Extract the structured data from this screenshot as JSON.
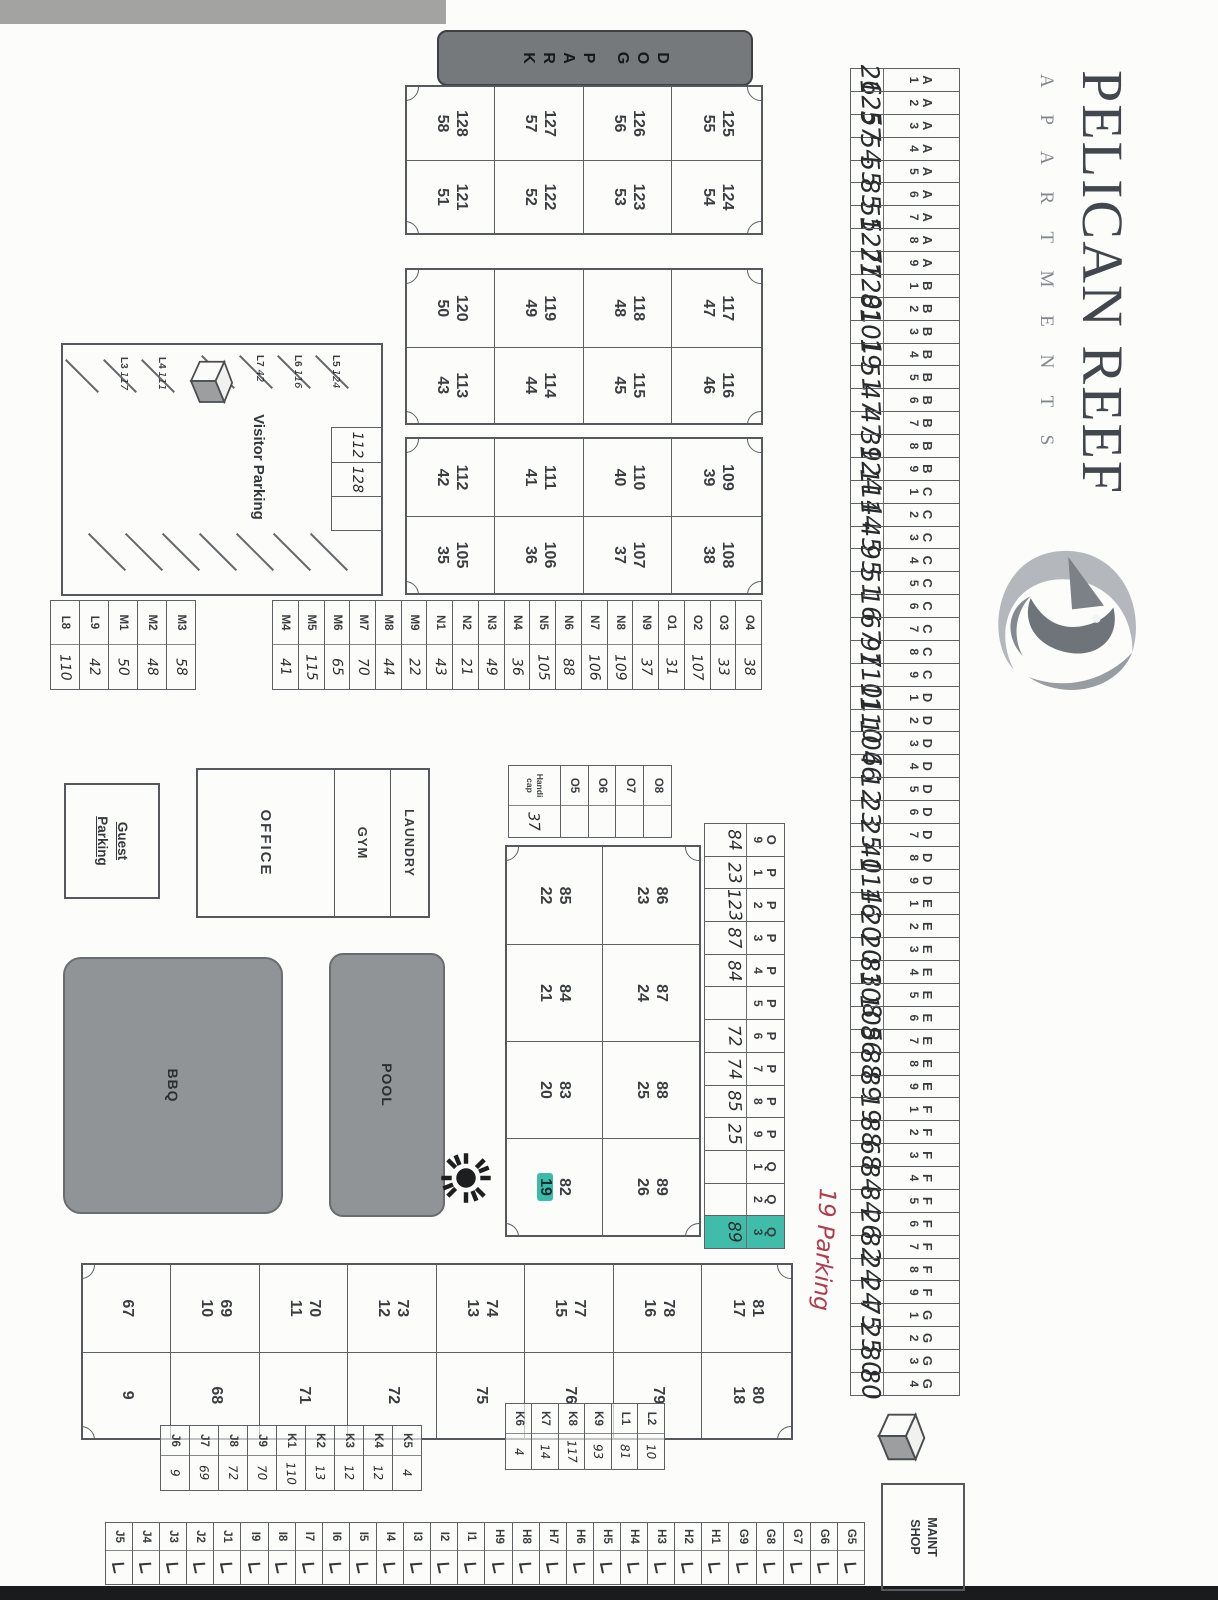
{
  "header": {
    "title": "PELICAN REEF",
    "subtitle": "A P A R T M E N T S"
  },
  "amenities": {
    "dog_park": "DOG PARK",
    "office": "OFFICE",
    "gym": "GYM",
    "laundry": "LAUNDRY",
    "pool": "POOL",
    "bbq": "BBQ",
    "guest_parking": "Guest Parking",
    "visitor_parking": "Visitor Parking",
    "maint_shop": "MAINT SHOP",
    "handicap_label": "Handi cap"
  },
  "annotations": {
    "red_note": "19 Parking",
    "red_color": "#b23b4b",
    "highlight_color": "#3bbcaa"
  },
  "parking": {
    "top_row": [
      {
        "s": "A1",
        "v": "26"
      },
      {
        "s": "A2",
        "v": "125"
      },
      {
        "s": "A3",
        "v": "57"
      },
      {
        "s": "A4",
        "v": "54"
      },
      {
        "s": "A5",
        "v": "55"
      },
      {
        "s": "A6",
        "v": "85"
      },
      {
        "s": "A7",
        "v": "55"
      },
      {
        "s": "A8",
        "v": "127"
      },
      {
        "s": "A9",
        "v": "27"
      },
      {
        "s": "B1",
        "v": "120"
      },
      {
        "s": "B2",
        "v": "81"
      },
      {
        "s": "B3",
        "v": "101"
      },
      {
        "s": "B4",
        "v": "19"
      },
      {
        "s": "B5",
        "v": "51"
      },
      {
        "s": "B6",
        "v": "47"
      },
      {
        "s": "B7",
        "v": "47"
      },
      {
        "s": "B8",
        "v": "39"
      },
      {
        "s": "B9",
        "v": "124"
      },
      {
        "s": "C1",
        "v": "114"
      },
      {
        "s": "C2",
        "v": "14"
      },
      {
        "s": "C3",
        "v": "45"
      },
      {
        "s": "C4",
        "v": "95"
      },
      {
        "s": "C5",
        "v": "51"
      },
      {
        "s": "C6",
        "v": "16"
      },
      {
        "s": "C7",
        "v": "67"
      },
      {
        "s": "C8",
        "v": "97"
      },
      {
        "s": "C9",
        "v": "110"
      },
      {
        "s": "D1",
        "v": "11"
      },
      {
        "s": "D2",
        "v": "110"
      },
      {
        "s": "D3",
        "v": "106"
      },
      {
        "s": "D4",
        "v": "46"
      },
      {
        "s": "D5",
        "v": "12"
      },
      {
        "s": "D6",
        "v": "23"
      },
      {
        "s": "D7",
        "v": "25"
      },
      {
        "s": "D8",
        "v": "40"
      },
      {
        "s": "D9",
        "v": "114"
      },
      {
        "s": "E1",
        "v": "16"
      },
      {
        "s": "E2",
        "v": "20"
      },
      {
        "s": "E3",
        "v": "20"
      },
      {
        "s": "E4",
        "v": "83"
      },
      {
        "s": "E5",
        "v": "108"
      },
      {
        "s": "E6",
        "v": "105"
      },
      {
        "s": "E7",
        "v": "86"
      },
      {
        "s": "E8",
        "v": "88"
      },
      {
        "s": "E9",
        "v": "89"
      },
      {
        "s": "F1",
        "v": "19"
      },
      {
        "s": "F2",
        "v": "88"
      },
      {
        "s": "F3",
        "v": "68"
      },
      {
        "s": "F4",
        "v": "84"
      },
      {
        "s": "F5",
        "v": "84"
      },
      {
        "s": "F6",
        "v": "26"
      },
      {
        "s": "F7",
        "v": "82"
      },
      {
        "s": "F8",
        "v": "24"
      },
      {
        "s": "F9",
        "v": "24"
      },
      {
        "s": "G1",
        "v": "75"
      },
      {
        "s": "G2",
        "v": "25"
      },
      {
        "s": "G3",
        "v": "80"
      },
      {
        "s": "G4",
        "v": "80"
      }
    ],
    "upper_row": [
      {
        "s": "O9",
        "v": "84"
      },
      {
        "s": "P1",
        "v": "23"
      },
      {
        "s": "P2",
        "v": "123"
      },
      {
        "s": "P3",
        "v": "87"
      },
      {
        "s": "P4",
        "v": "84"
      },
      {
        "s": "P5",
        "v": ""
      },
      {
        "s": "P6",
        "v": "72"
      },
      {
        "s": "P7",
        "v": "74"
      },
      {
        "s": "P8",
        "v": "85"
      },
      {
        "s": "P9",
        "v": "25"
      },
      {
        "s": "Q1",
        "v": ""
      },
      {
        "s": "Q2",
        "v": ""
      },
      {
        "s": "Q3",
        "v": "89",
        "hl": true
      }
    ],
    "office_row": [
      {
        "s": "O8",
        "v": ""
      },
      {
        "s": "O7",
        "v": ""
      },
      {
        "s": "O6",
        "v": ""
      },
      {
        "s": "O5",
        "v": ""
      },
      {
        "s": "Handicap",
        "v": "37"
      }
    ],
    "center_column": [
      {
        "s": "O4",
        "v": "38"
      },
      {
        "s": "O3",
        "v": "33"
      },
      {
        "s": "O2",
        "v": "107"
      },
      {
        "s": "O1",
        "v": "31"
      },
      {
        "s": "N9",
        "v": "37"
      },
      {
        "s": "N8",
        "v": "109"
      },
      {
        "s": "N7",
        "v": "106"
      },
      {
        "s": "N6",
        "v": "88"
      },
      {
        "s": "N5",
        "v": "105"
      },
      {
        "s": "N4",
        "v": "36"
      },
      {
        "s": "N3",
        "v": "49"
      },
      {
        "s": "N2",
        "v": "21"
      },
      {
        "s": "N1",
        "v": "43"
      },
      {
        "s": "M9",
        "v": "22"
      },
      {
        "s": "M8",
        "v": "44"
      },
      {
        "s": "M7",
        "v": "70"
      },
      {
        "s": "M6",
        "v": "65"
      },
      {
        "s": "M5",
        "v": "115"
      },
      {
        "s": "M4",
        "v": "41"
      }
    ],
    "lower_column": [
      {
        "s": "M3",
        "v": "58"
      },
      {
        "s": "M2",
        "v": "48"
      },
      {
        "s": "M1",
        "v": "50"
      },
      {
        "s": "L9",
        "v": "42"
      },
      {
        "s": "L8",
        "v": "110"
      }
    ],
    "l_column": [
      {
        "s": "L2",
        "v": "10"
      },
      {
        "s": "L1",
        "v": "81"
      },
      {
        "s": "K9",
        "v": "93"
      },
      {
        "s": "K8",
        "v": "117"
      },
      {
        "s": "K7",
        "v": "14"
      },
      {
        "s": "K6",
        "v": "4"
      }
    ],
    "k_column": [
      {
        "s": "K5",
        "v": "4"
      },
      {
        "s": "K4",
        "v": "12"
      },
      {
        "s": "K3",
        "v": "12"
      },
      {
        "s": "K2",
        "v": "13"
      },
      {
        "s": "K1",
        "v": "110"
      },
      {
        "s": "J9",
        "v": "70"
      },
      {
        "s": "J8",
        "v": "72"
      },
      {
        "s": "J7",
        "v": "69"
      },
      {
        "s": "J6",
        "v": "9"
      }
    ],
    "right_column": [
      {
        "s": "G5",
        "tick": true
      },
      {
        "s": "G6",
        "tick": true
      },
      {
        "s": "G7",
        "tick": true
      },
      {
        "s": "G8",
        "tick": true
      },
      {
        "s": "G9",
        "tick": true
      },
      {
        "s": "H1",
        "tick": true
      },
      {
        "s": "H2",
        "tick": true
      },
      {
        "s": "H3",
        "tick": true
      },
      {
        "s": "H4",
        "tick": true
      },
      {
        "s": "H5",
        "tick": true
      },
      {
        "s": "H6",
        "tick": true
      },
      {
        "s": "H7",
        "tick": true
      },
      {
        "s": "H8",
        "tick": true
      },
      {
        "s": "H9",
        "tick": true
      },
      {
        "s": "I1",
        "tick": true
      },
      {
        "s": "I2",
        "tick": true
      },
      {
        "s": "I3",
        "tick": true
      },
      {
        "s": "I4",
        "tick": true
      },
      {
        "s": "I5",
        "tick": true
      },
      {
        "s": "I6",
        "tick": true
      },
      {
        "s": "I7",
        "tick": true
      },
      {
        "s": "I8",
        "tick": true
      },
      {
        "s": "I9",
        "tick": true
      },
      {
        "s": "J1",
        "tick": true
      },
      {
        "s": "J2",
        "tick": true
      },
      {
        "s": "J3",
        "tick": true
      },
      {
        "s": "J4",
        "tick": true
      },
      {
        "s": "J5",
        "tick": true
      }
    ]
  },
  "buildings": [
    {
      "name": "building-121-128",
      "rows": [
        [
          {
            "u": "125",
            "l": "55"
          },
          {
            "u": "124",
            "l": "54"
          }
        ],
        [
          {
            "u": "126",
            "l": "56"
          },
          {
            "u": "123",
            "l": "53"
          }
        ],
        [
          {
            "u": "127",
            "l": "57"
          },
          {
            "u": "122",
            "l": "52"
          }
        ],
        [
          {
            "u": "128",
            "l": "58"
          },
          {
            "u": "121",
            "l": "51"
          }
        ]
      ]
    },
    {
      "name": "building-113-120",
      "rows": [
        [
          {
            "u": "117",
            "l": "47"
          },
          {
            "u": "116",
            "l": "46"
          }
        ],
        [
          {
            "u": "118",
            "l": "48"
          },
          {
            "u": "115",
            "l": "45"
          }
        ],
        [
          {
            "u": "119",
            "l": "49"
          },
          {
            "u": "114",
            "l": "44"
          }
        ],
        [
          {
            "u": "120",
            "l": "50"
          },
          {
            "u": "113",
            "l": "43"
          }
        ]
      ]
    },
    {
      "name": "building-105-112",
      "rows": [
        [
          {
            "u": "109",
            "l": "39"
          },
          {
            "u": "108",
            "l": "38"
          }
        ],
        [
          {
            "u": "110",
            "l": "40"
          },
          {
            "u": "107",
            "l": "37"
          }
        ],
        [
          {
            "u": "111",
            "l": "41"
          },
          {
            "u": "106",
            "l": "36"
          }
        ],
        [
          {
            "u": "112",
            "l": "42"
          },
          {
            "u": "105",
            "l": "35"
          }
        ]
      ]
    },
    {
      "name": "building-82-89",
      "rows": [
        [
          {
            "u": "86",
            "l": "23"
          },
          {
            "u": "87",
            "l": "24"
          },
          {
            "u": "88",
            "l": "25"
          },
          {
            "u": "89",
            "l": "26"
          }
        ],
        [
          {
            "u": "85",
            "l": "22"
          },
          {
            "u": "84",
            "l": "21"
          },
          {
            "u": "83",
            "l": "20"
          },
          {
            "u": "82",
            "l": "19",
            "hl": true
          }
        ]
      ]
    },
    {
      "name": "building-67-81",
      "rows": [
        [
          {
            "u": "81",
            "l": "17"
          },
          {
            "u": "80",
            "l": "18"
          }
        ],
        [
          {
            "u": "78",
            "l": "16"
          },
          {
            "u": "79",
            "l": ""
          }
        ],
        [
          {
            "u": "77",
            "l": "15"
          },
          {
            "u": "76",
            "l": ""
          }
        ],
        [
          {
            "u": "74",
            "l": "13"
          },
          {
            "u": "75",
            "l": ""
          }
        ],
        [
          {
            "u": "73",
            "l": "12"
          },
          {
            "u": "72",
            "l": ""
          }
        ],
        [
          {
            "u": "70",
            "l": "11"
          },
          {
            "u": "71",
            "l": ""
          }
        ],
        [
          {
            "u": "69",
            "l": "10"
          },
          {
            "u": "68",
            "l": ""
          }
        ],
        [
          {
            "u": "67",
            "l": ""
          },
          {
            "u": "9",
            "l": ""
          }
        ]
      ]
    }
  ],
  "visitor_area": {
    "slots": [
      {
        "s": "L5",
        "v": "124"
      },
      {
        "s": "L6",
        "v": "116"
      },
      {
        "s": "L7",
        "v": "42"
      },
      {
        "s": "L4",
        "v": "111"
      },
      {
        "s": "L3",
        "v": "117"
      }
    ],
    "cells": [
      "112",
      "128",
      ""
    ]
  }
}
